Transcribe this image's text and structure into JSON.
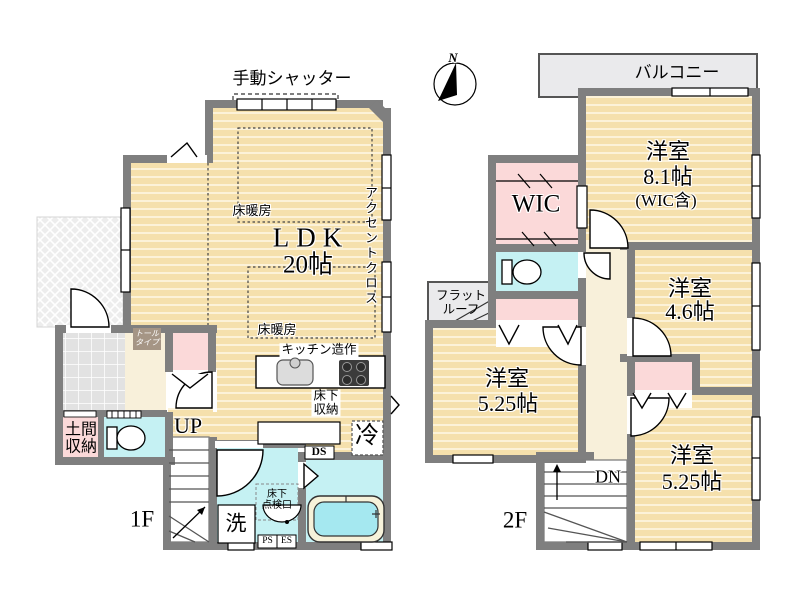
{
  "compass": {
    "north": "N"
  },
  "floor1": {
    "floor_label": "1F",
    "shutter": "手動シャッター",
    "ldk_name": "LDK",
    "ldk_size": "20帖",
    "floor_heating_upper": "床暖房",
    "floor_heating_lower": "床暖房",
    "accent_cloth": "アクセントクロス",
    "kitchen_builtin": "キッチン造作",
    "underfloor_storage": "床下\n収納",
    "fridge": "冷",
    "duct_space": "DS",
    "stairs_up": "UP",
    "doma_storage": "土間\n収納",
    "tall_cabinet": "トール\nタイプ",
    "inspection_hatch": "床下\n点検口",
    "washer": "洗",
    "pipe_space": "PS",
    "electric_space": "ES"
  },
  "floor2": {
    "floor_label": "2F",
    "balcony": "バルコニー",
    "flat_roof": "フラット\nルーフ",
    "wic": "WIC",
    "room_main_name": "洋室",
    "room_main_size": "8.1帖",
    "room_main_note": "(WIC含)",
    "room_46_name": "洋室",
    "room_46_size": "4.6帖",
    "room_525L_name": "洋室",
    "room_525L_size": "5.25帖",
    "room_525R_name": "洋室",
    "room_525R_size": "5.25帖",
    "stairs_down": "DN"
  },
  "colors": {
    "wall": "#7f7f7f",
    "wood_floor": "#f5e0ac",
    "closet_pink": "#fbd9d9",
    "wet_area_cyan": "#c5f1f3",
    "hall_cream": "#f8f0da",
    "balcony_gray": "#eaeaec",
    "bath_water": "#a5e8f0"
  }
}
